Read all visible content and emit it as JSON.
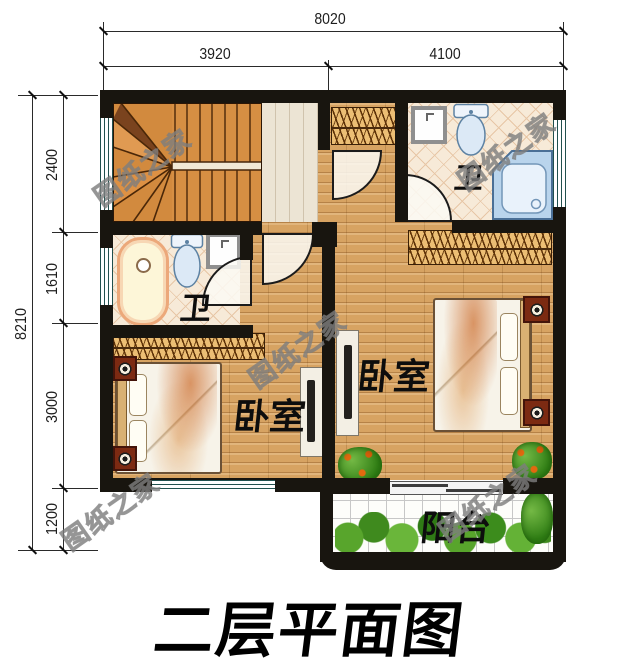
{
  "title": {
    "text": "二层平面图"
  },
  "watermark": {
    "text": "图纸之家"
  },
  "dimensions": {
    "top_total": "8020",
    "top_left": "3920",
    "top_right": "4100",
    "side_total": "8210",
    "side_1": "2400",
    "side_2": "1610",
    "side_3": "3000",
    "side_4": "1200"
  },
  "rooms": {
    "bathroom_left": "卫",
    "bathroom_right": "卫",
    "bedroom_left": "卧室",
    "bedroom_right": "卧室",
    "balcony": "阳台"
  },
  "colors": {
    "wall": "#18150f",
    "wood_floor": "#d7a362",
    "stair_wood": "#d28a3e",
    "bath_tile": "#f7ead8",
    "balcony_tile": "#fdfdfa",
    "plant_green": "#3f8a1e",
    "nightstand_red": "#7c2a12",
    "window_teal": "#21504e"
  }
}
